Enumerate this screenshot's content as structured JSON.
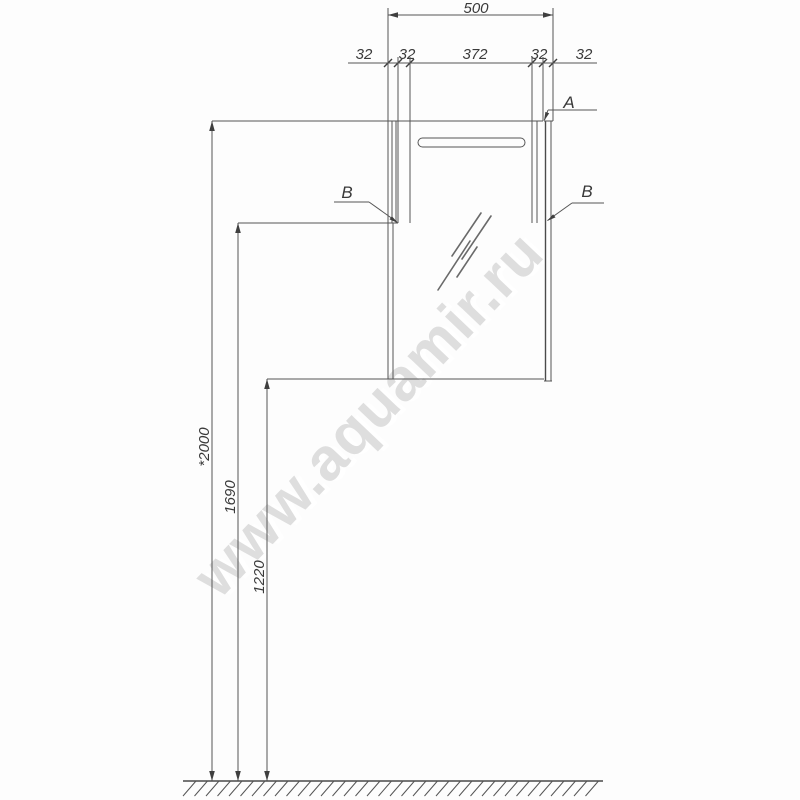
{
  "drawing": {
    "type_note": "installation dimension drawing of wall mirror cabinet",
    "ink_color": "#4a4a4a",
    "background_color": "#fdfdfd",
    "watermark": {
      "text": "www.aquamir.ru",
      "color": "#dedede"
    },
    "top_dimension": {
      "total": "500",
      "segments": [
        "32",
        "32",
        "372",
        "32",
        "32"
      ]
    },
    "vertical_dimensions": {
      "to_top": "*2000",
      "to_mid": "1690",
      "to_bottom": "1220"
    },
    "callouts": {
      "top_right": "A",
      "left": "B",
      "right": "B"
    }
  }
}
